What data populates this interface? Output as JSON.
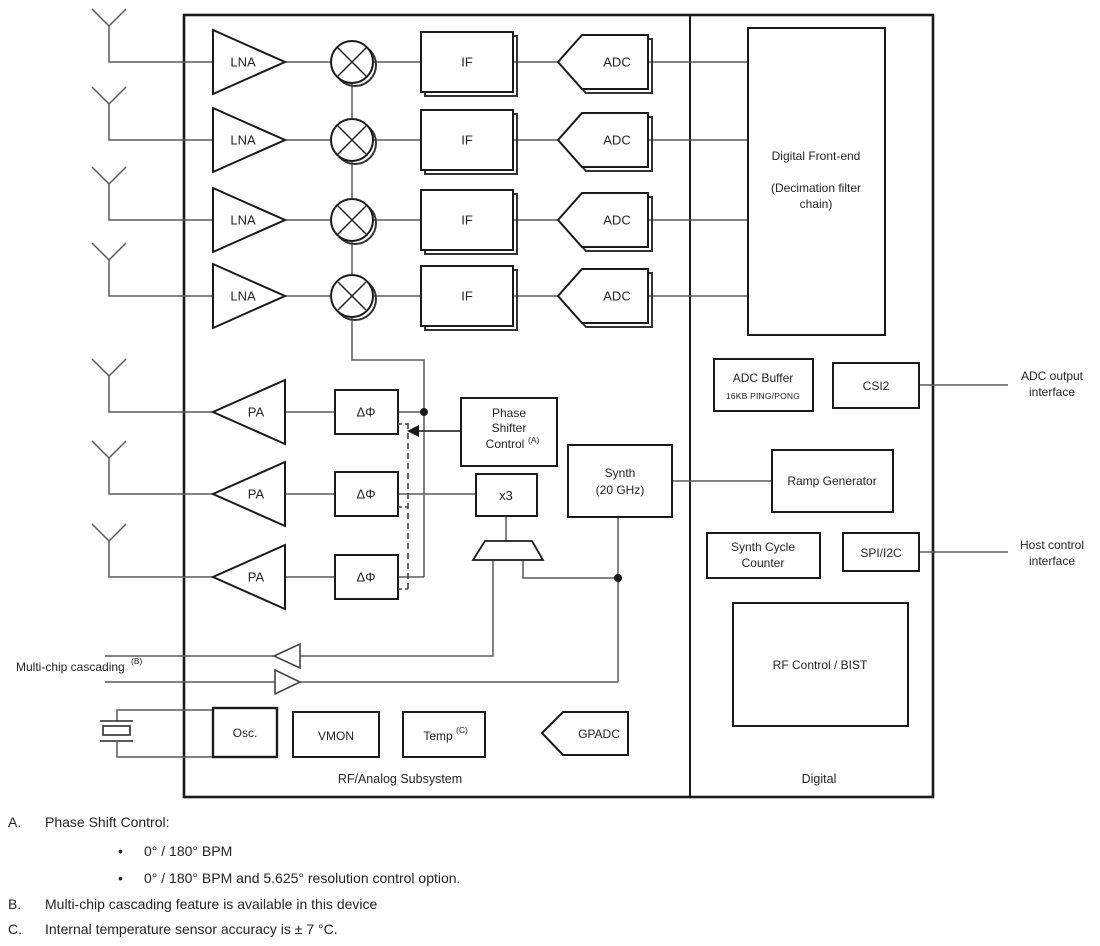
{
  "chip": {
    "rx_chains": {
      "count": 4,
      "lna_label": "LNA",
      "if_label": "IF",
      "adc_label": "ADC"
    },
    "tx_chains": {
      "count": 3,
      "pa_label": "PA",
      "phase_shifter_label": "ΔΦ"
    },
    "digital_front_end": {
      "line1": "Digital Front-end",
      "line2": "(Decimation filter",
      "line3": "chain)"
    },
    "adc_buffer": {
      "title": "ADC Buffer",
      "subtitle": "16KB PING/PONG"
    },
    "csi2_label": "CSI2",
    "ramp_generator_label": "Ramp Generator",
    "synth": {
      "line1": "Synth",
      "line2": "(20 GHz)"
    },
    "synth_cycle_counter": {
      "line1": "Synth Cycle",
      "line2": "Counter"
    },
    "spi_i2c_label": "SPI/I2C",
    "rf_control_bist_label": "RF Control / BIST",
    "phase_shifter_control": {
      "line1": "Phase",
      "line2": "Shifter",
      "line3": "Control",
      "footnote_ref": "(A)"
    },
    "multiplier_label": "x3",
    "osc_label": "Osc.",
    "vmon_label": "VMON",
    "temp": {
      "label": "Temp",
      "footnote_ref": "(C)"
    },
    "gpadc_label": "GPADC",
    "region_labels": {
      "rf_analog": "RF/Analog Subsystem",
      "digital": "Digital"
    }
  },
  "external_labels": {
    "multi_chip_cascading": {
      "label": "Multi-chip cascading",
      "footnote_ref": "(B)"
    },
    "adc_output_interface": {
      "line1": "ADC output",
      "line2": "interface"
    },
    "host_control_interface": {
      "line1": "Host control",
      "line2": "interface"
    }
  },
  "footnotes": {
    "bullet_char": "•",
    "a_marker": "A.",
    "a_text": "Phase Shift Control:",
    "a_bullet1": "0° / 180° BPM",
    "a_bullet2": "0° / 180° BPM and 5.625° resolution control option.",
    "b_marker": "B.",
    "b_text": "Multi-chip cascading feature is available in this device",
    "c_marker": "C.",
    "c_text": "Internal temperature sensor accuracy is ± 7 °C."
  },
  "colors": {
    "background": "#ffffff",
    "wire": "#5a5a5a",
    "box_border": "#1a1a1a",
    "shadow": "#333333",
    "text": "#242424"
  }
}
